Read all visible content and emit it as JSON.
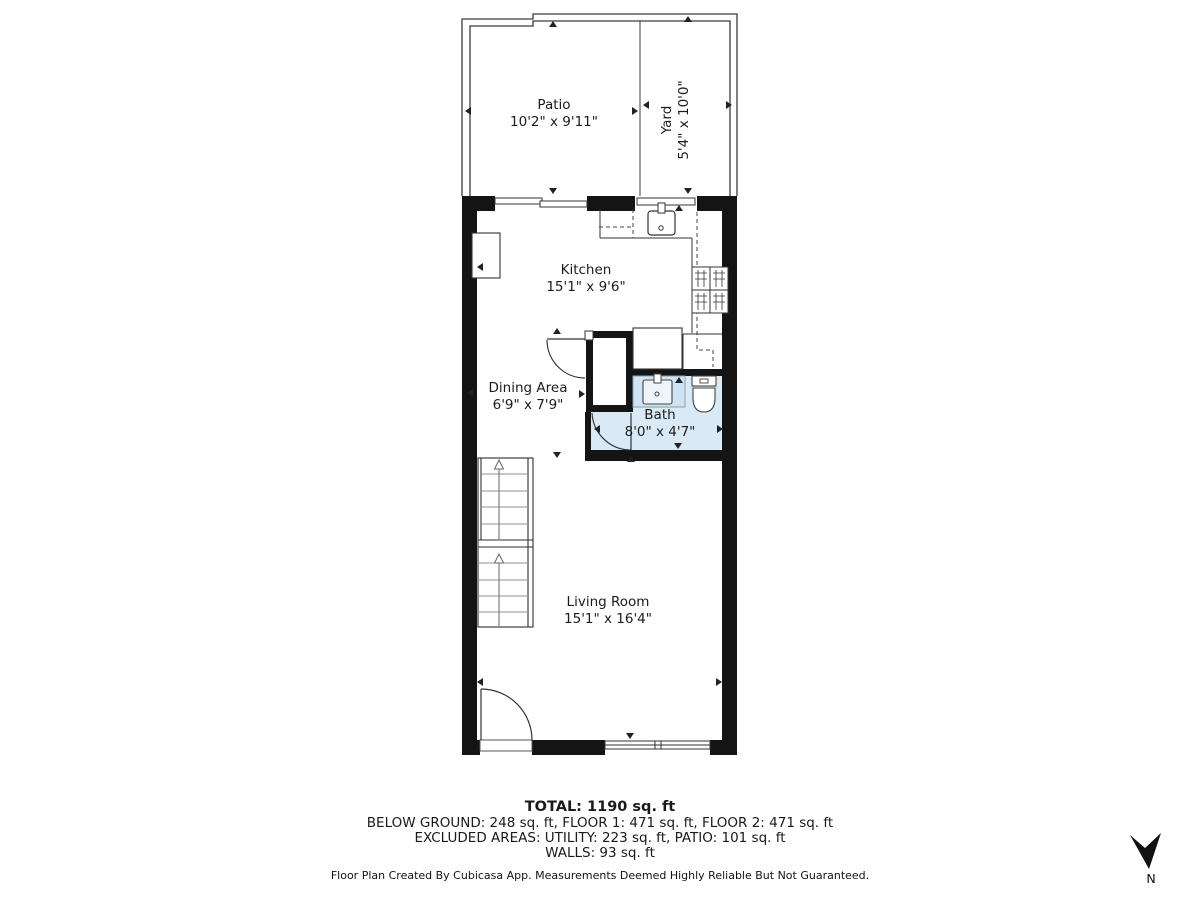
{
  "rooms": [
    {
      "name": "Patio",
      "dims": "10'2\" x 9'11\""
    },
    {
      "name": "Yard",
      "dims": "5'4\" x 10'0\""
    },
    {
      "name": "Kitchen",
      "dims": "15'1\" x 9'6\""
    },
    {
      "name": "Dining Area",
      "dims": "6'9\" x 7'9\""
    },
    {
      "name": "Bath",
      "dims": "8'0\" x 4'7\""
    },
    {
      "name": "Living Room",
      "dims": "15'1\" x 16'4\""
    }
  ],
  "footer": {
    "total": "TOTAL: 1190 sq. ft",
    "floors": "BELOW GROUND: 248 sq. ft, FLOOR 1: 471 sq. ft, FLOOR 2: 471 sq. ft",
    "excluded": "EXCLUDED AREAS: UTILITY: 223 sq. ft, PATIO: 101 sq. ft",
    "walls": "WALLS: 93 sq. ft",
    "disclaimer": "Floor Plan Created By Cubicasa App. Measurements Deemed Highly Reliable But Not Guaranteed."
  },
  "compass": {
    "label": "N"
  },
  "colors": {
    "wall": "#141414",
    "bath_floor": "#d9eaf6",
    "line": "#3c3c3c"
  }
}
